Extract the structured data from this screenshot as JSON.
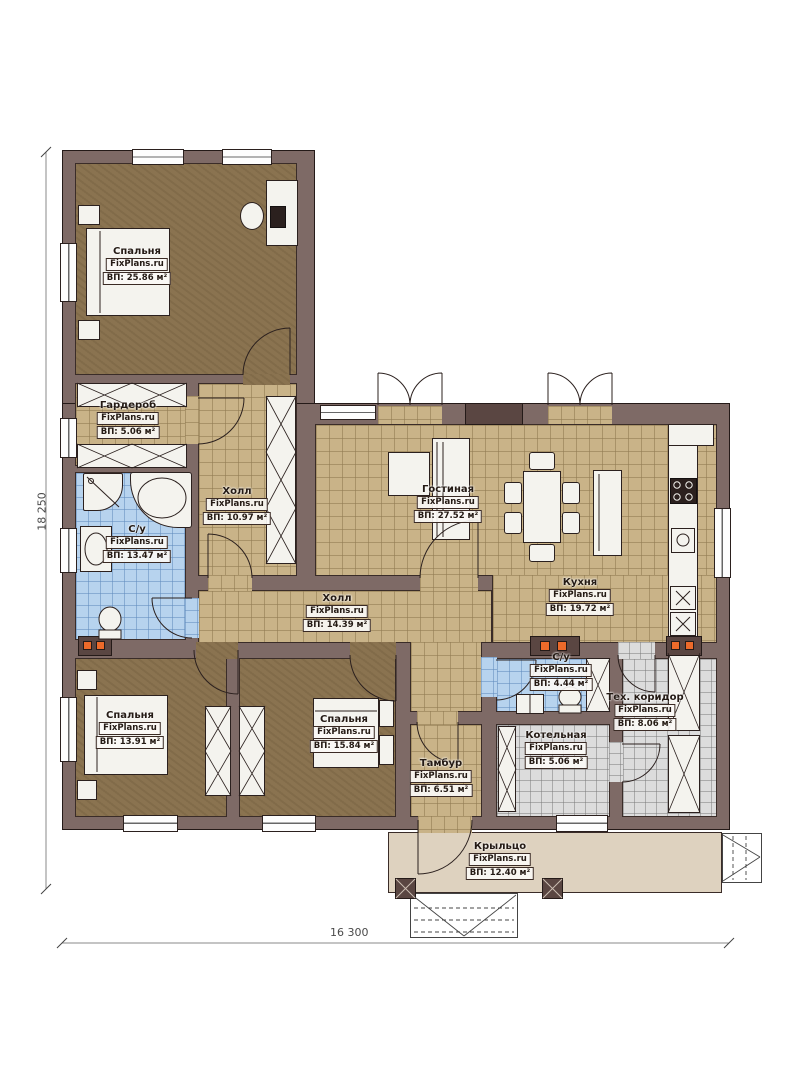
{
  "plan": {
    "rooms": [
      {
        "name": "Спальня",
        "watermark": "FixPlans.ru",
        "area": "ВП: 25.86 м²"
      },
      {
        "name": "Гардероб",
        "watermark": "FixPlans.ru",
        "area": "ВП: 5.06 м²"
      },
      {
        "name": "Холл",
        "watermark": "FixPlans.ru",
        "area": "ВП: 10.97 м²"
      },
      {
        "name": "С/у",
        "watermark": "FixPlans.ru",
        "area": "ВП: 13.47 м²"
      },
      {
        "name": "Гостиная",
        "watermark": "FixPlans.ru",
        "area": "ВП: 27.52 м²"
      },
      {
        "name": "Кухня",
        "watermark": "FixPlans.ru",
        "area": "ВП: 19.72 м²"
      },
      {
        "name": "Холл",
        "watermark": "FixPlans.ru",
        "area": "ВП: 14.39 м²"
      },
      {
        "name": "Спальня",
        "watermark": "FixPlans.ru",
        "area": "ВП: 13.91 м²"
      },
      {
        "name": "Спальня",
        "watermark": "FixPlans.ru",
        "area": "ВП: 15.84 м²"
      },
      {
        "name": "Тамбур",
        "watermark": "FixPlans.ru",
        "area": "ВП: 6.51 м²"
      },
      {
        "name": "С/у",
        "watermark": "FixPlans.ru",
        "area": "ВП: 4.44 м²"
      },
      {
        "name": "Котельная",
        "watermark": "FixPlans.ru",
        "area": "ВП: 5.06 м²"
      },
      {
        "name": "Тех. коридор",
        "watermark": "FixPlans.ru",
        "area": "ВП: 8.06 м²"
      },
      {
        "name": "Крыльцо",
        "watermark": "FixPlans.ru",
        "area": "ВП: 12.40 м²"
      }
    ],
    "dimensions": {
      "left": "18 250",
      "bottom": "16 300"
    },
    "colors": {
      "wall": "#7e6a66",
      "floor_wood": "#8a7350",
      "floor_tile_tan": "#c9b388",
      "floor_tile_blue": "#b7d3ee",
      "floor_tile_gray": "#dcdcdc",
      "porch": "#ded2bf",
      "vent_accent": "#ec6a2a"
    }
  }
}
